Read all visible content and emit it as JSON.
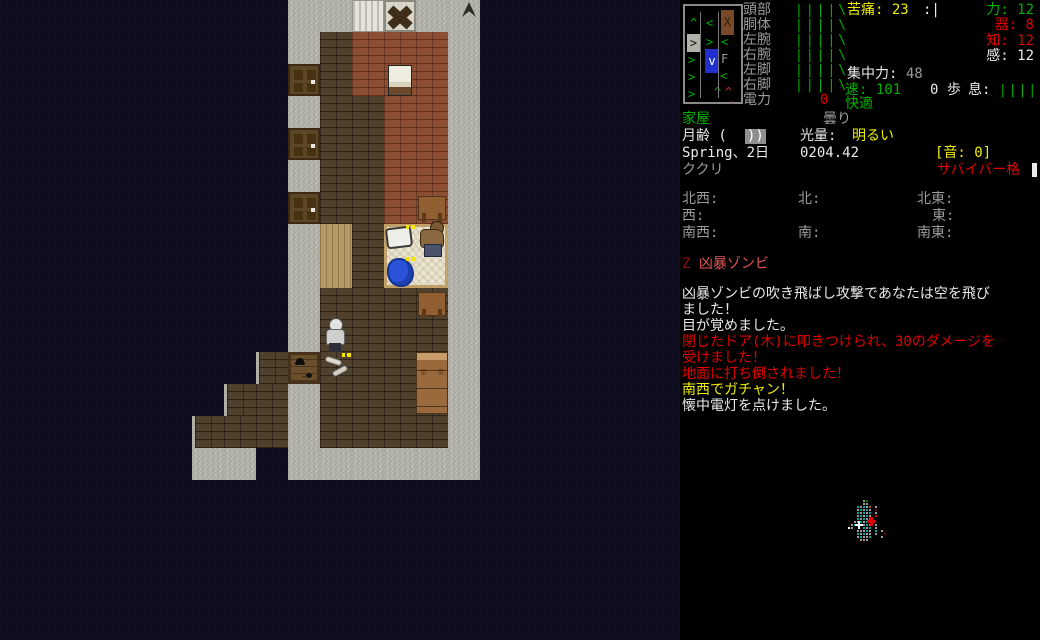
{
  "sidebar": {
    "body_parts": [
      {
        "label": "頭部",
        "bars": "||||\\"
      },
      {
        "label": "胴体",
        "bars": "||||\\"
      },
      {
        "label": "左腕",
        "bars": "||||\\"
      },
      {
        "label": "右腕",
        "bars": "||||\\"
      },
      {
        "label": "左脚",
        "bars": "||||\\"
      },
      {
        "label": "右脚",
        "bars": "||||\\"
      }
    ],
    "power": {
      "label": "電力",
      "value": "0"
    },
    "pain": {
      "label": "苦痛:",
      "value": "23"
    },
    "morale": ":|",
    "stats": [
      {
        "label": "力:",
        "value": "12",
        "color": "green"
      },
      {
        "label": "器:",
        "value": "8",
        "color": "red"
      },
      {
        "label": "知:",
        "value": "12",
        "color": "red"
      },
      {
        "label": "感:",
        "value": "12",
        "color": "white"
      }
    ],
    "focus": {
      "label": "集中力:",
      "value": "48"
    },
    "speed": {
      "label": "速:",
      "value": "101"
    },
    "moves": "0 歩",
    "breath": {
      "label": "息:",
      "bars": "|||||"
    },
    "comfort": "快適",
    "location": "家屋",
    "weather": "曇り",
    "moon": {
      "label": "月齢 (",
      "phase": "))"
    },
    "light": {
      "label": "光量:",
      "value": "明るい"
    },
    "date": "Spring、2日",
    "time": "0204.42",
    "sound": "[音: 0]",
    "weapon": "ククリ",
    "style": "サバイバー格",
    "compass": {
      "nw": "北西:",
      "n": "北:",
      "ne": "北東:",
      "w": "西:",
      "e": "東:",
      "sw": "南西:",
      "s": "南:",
      "se": "南東:"
    },
    "enemy_list": {
      "symbol": "Z",
      "name": "凶暴ゾンビ"
    },
    "messages": [
      {
        "text": "凶暴ゾンビの吹き飛ばし攻撃であなたは空を飛び",
        "color": "white"
      },
      {
        "text": "ました！",
        "color": "white"
      },
      {
        "text": "目が覚めました。",
        "color": "white"
      },
      {
        "text": "閉じたドア(木)に叩きつけられ、30のダメージを",
        "color": "red"
      },
      {
        "text": "受けました！",
        "color": "red"
      },
      {
        "text": "地面に打ち倒されました！",
        "color": "red"
      },
      {
        "text": "南西でガチャン！",
        "color": "yellow"
      },
      {
        "text": "懐中電灯を点けました。",
        "color": "white"
      }
    ],
    "bodygraph_glyphs": [
      {
        "ch": "^",
        "x": 5,
        "y": 11,
        "c": "#00b000"
      },
      {
        "ch": "<",
        "x": 21,
        "y": 11,
        "c": "#00b000"
      },
      {
        "ch": "X",
        "x": 36,
        "y": 4,
        "c": "#2e1c0c",
        "bg": "#7a4a28",
        "w": 13,
        "h": 25
      },
      {
        "ch": ">",
        "x": 2,
        "y": 28,
        "c": "#111111",
        "bg": "#b2b2aa",
        "w": 13,
        "h": 18
      },
      {
        "ch": ">",
        "x": 21,
        "y": 30,
        "c": "#00b000"
      },
      {
        "ch": "<",
        "x": 36,
        "y": 30,
        "c": "#00b000"
      },
      {
        "ch": ">",
        "x": 3,
        "y": 48,
        "c": "#00b000"
      },
      {
        "ch": "v",
        "x": 20,
        "y": 43,
        "c": "#ffffff",
        "bg": "#2030cf",
        "w": 14,
        "h": 24
      },
      {
        "ch": "F",
        "x": 36,
        "y": 47,
        "c": "#999999"
      },
      {
        "ch": ">",
        "x": 3,
        "y": 65,
        "c": "#00b000"
      },
      {
        "ch": "<",
        "x": 35,
        "y": 64,
        "c": "#00b000"
      },
      {
        "ch": ">",
        "x": 3,
        "y": 82,
        "c": "#00b000"
      },
      {
        "ch": "^",
        "x": 29,
        "y": 80,
        "c": "#00b000"
      },
      {
        "ch": "^",
        "x": 40,
        "y": 80,
        "c": "#c03030"
      },
      {
        "ch": ".",
        "x": 43,
        "y": 87,
        "c": "#c03030"
      }
    ],
    "minimap": {
      "origin": {
        "left": 168,
        "top": 500,
        "pitch": 3
      },
      "palette": {
        "c": "#00a3a3",
        "g": "#9a9a9a",
        "w": "#ffffff",
        "r": "#e00000",
        "d": "#7a0000",
        "n": "#0a7a00",
        "o": "#a65c20"
      },
      "dots": [
        [
          5,
          0,
          "g"
        ],
        [
          6,
          0,
          "n"
        ],
        [
          5,
          1,
          "g"
        ],
        [
          6,
          1,
          "g"
        ],
        [
          3,
          2,
          "c"
        ],
        [
          4,
          2,
          "g"
        ],
        [
          5,
          2,
          "c"
        ],
        [
          6,
          2,
          "g"
        ],
        [
          7,
          2,
          "o"
        ],
        [
          9,
          2,
          "g"
        ],
        [
          3,
          3,
          "g"
        ],
        [
          4,
          3,
          "c"
        ],
        [
          5,
          3,
          "g"
        ],
        [
          6,
          3,
          "c"
        ],
        [
          7,
          3,
          "g"
        ],
        [
          9,
          3,
          "d"
        ],
        [
          3,
          4,
          "c"
        ],
        [
          4,
          4,
          "g"
        ],
        [
          5,
          4,
          "c"
        ],
        [
          6,
          4,
          "g"
        ],
        [
          7,
          4,
          "c"
        ],
        [
          9,
          4,
          "g"
        ],
        [
          3,
          5,
          "g"
        ],
        [
          4,
          5,
          "c"
        ],
        [
          5,
          5,
          "g"
        ],
        [
          6,
          5,
          "c"
        ],
        [
          7,
          5,
          "g"
        ],
        [
          9,
          5,
          "r"
        ],
        [
          3,
          6,
          "c"
        ],
        [
          4,
          6,
          "g"
        ],
        [
          5,
          6,
          "c"
        ],
        [
          6,
          6,
          "g"
        ],
        [
          7,
          6,
          "c"
        ],
        [
          2,
          7,
          "g"
        ],
        [
          3,
          7,
          "g"
        ],
        [
          4,
          7,
          "c"
        ],
        [
          5,
          7,
          "g"
        ],
        [
          6,
          7,
          "c"
        ],
        [
          1,
          8,
          "g"
        ],
        [
          2,
          8,
          "c"
        ],
        [
          5,
          8,
          "g"
        ],
        [
          6,
          8,
          "c"
        ],
        [
          7,
          8,
          "g"
        ],
        [
          9,
          8,
          "g"
        ],
        [
          0,
          9,
          "w"
        ],
        [
          1,
          9,
          "g"
        ],
        [
          5,
          9,
          "c"
        ],
        [
          6,
          9,
          "g"
        ],
        [
          7,
          9,
          "c"
        ],
        [
          9,
          9,
          "g"
        ],
        [
          3,
          10,
          "g"
        ],
        [
          4,
          10,
          "g"
        ],
        [
          5,
          10,
          "g"
        ],
        [
          6,
          10,
          "c"
        ],
        [
          7,
          10,
          "g"
        ],
        [
          9,
          10,
          "c"
        ],
        [
          11,
          10,
          "g"
        ],
        [
          3,
          11,
          "c"
        ],
        [
          4,
          11,
          "g"
        ],
        [
          5,
          11,
          "c"
        ],
        [
          6,
          11,
          "g"
        ],
        [
          7,
          11,
          "g"
        ],
        [
          9,
          11,
          "g"
        ],
        [
          12,
          11,
          "d"
        ],
        [
          3,
          12,
          "g"
        ],
        [
          4,
          12,
          "c"
        ],
        [
          5,
          12,
          "g"
        ],
        [
          6,
          12,
          "g"
        ],
        [
          7,
          12,
          "c"
        ],
        [
          11,
          12,
          "g"
        ],
        [
          4,
          13,
          "g"
        ],
        [
          5,
          13,
          "g"
        ],
        [
          6,
          13,
          "g"
        ]
      ],
      "player_marker": {
        "left": 7,
        "top": 21
      },
      "enemy_marker": {
        "left": 19,
        "top": 17
      }
    }
  },
  "map": {
    "tile_size": 32,
    "legend": {
      "G": "stone-floor",
      "K": "dark-brick-floor",
      "L": "dark-brick-step",
      "R": "red-brick-floor",
      "D": "wooden-door",
      "W": "curtained-window",
      "X": "smashed-window",
      "w": "wood-floor",
      "B": "bed",
      "S": "wooden-crate",
      ".": "unseen"
    },
    "grid": [
      ".........GGWXGG......",
      ".........GKRRRG......",
      ".........DKRRRG......",
      ".........GKKRRG......",
      ".........DKKRRG......",
      ".........GKKRRG......",
      ".........DKKRRG......",
      ".........GwKBBG......",
      ".........GwKBBG......",
      ".........GKKKKG......",
      ".........GKKKKG......",
      "........LSKKKKG......",
      ".......LKGKKKKG......",
      "......LKKGKKKKG......",
      "......GG.GGGGGG......"
    ],
    "entities": [
      {
        "type": "corner-mark",
        "col": 14,
        "row": 0
      },
      {
        "type": "chair",
        "col": 12,
        "row": 2
      },
      {
        "type": "table",
        "col": 13,
        "row": 6
      },
      {
        "type": "bed-frame",
        "col": 12,
        "row": 7
      },
      {
        "type": "pillow",
        "col": 12,
        "row": 7
      },
      {
        "type": "item-marker",
        "col": 12,
        "row": 7
      },
      {
        "type": "zombie",
        "col": 13,
        "row": 7
      },
      {
        "type": "blanket",
        "col": 12,
        "row": 8
      },
      {
        "type": "item-marker",
        "col": 12,
        "row": 8
      },
      {
        "type": "table",
        "col": 13,
        "row": 9
      },
      {
        "type": "player",
        "col": 10,
        "row": 10
      },
      {
        "type": "spiders",
        "col": 9,
        "row": 11
      },
      {
        "type": "bones",
        "col": 10,
        "row": 11
      },
      {
        "type": "item-marker",
        "col": 10,
        "row": 11
      },
      {
        "type": "dresser",
        "col": 13,
        "row": 11
      }
    ]
  },
  "colors": {
    "green": "#00b000",
    "red": "#e00000",
    "yellow": "#f0f000",
    "gray": "#9a9a9a",
    "white": "#eaeaea"
  }
}
